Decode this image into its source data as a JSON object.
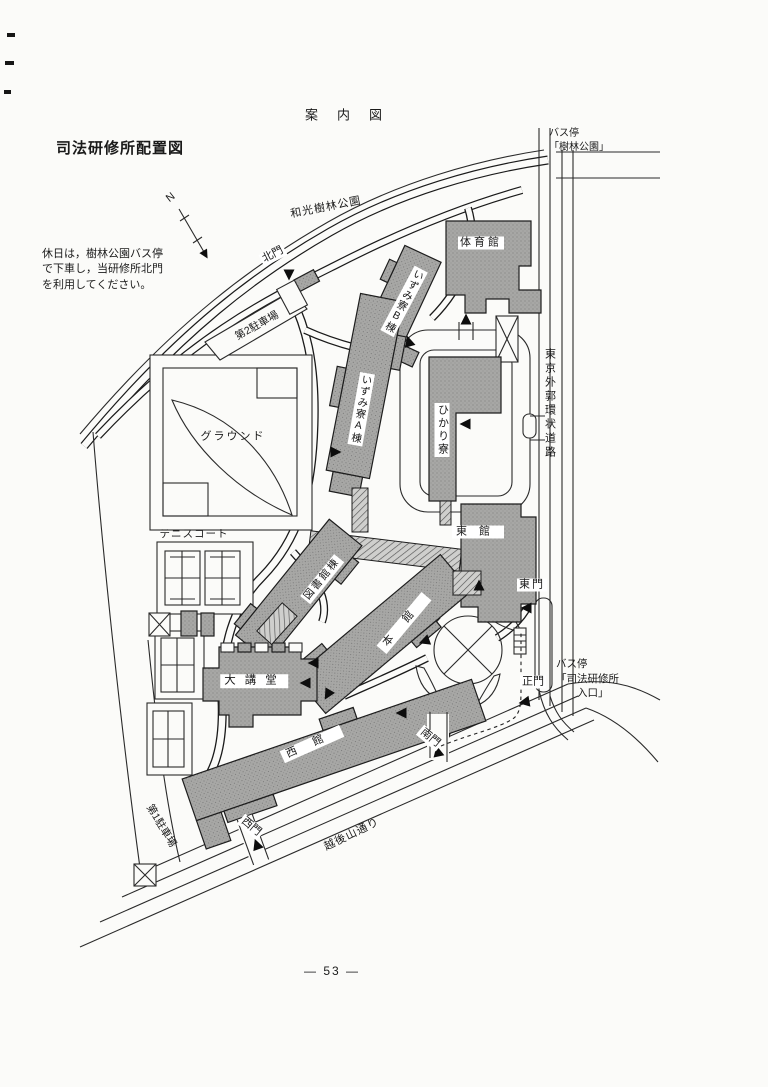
{
  "page": {
    "title": "案　内　図",
    "heading": "司法研修所配置図",
    "note": "休日は，樹林公園バス停\nで下車し，当研修所北門\nを利用してください。",
    "page_number": "— 53 —"
  },
  "map": {
    "compass_label": "N",
    "bus_stop_north": "バス停\n「樹林公園」",
    "bus_stop_east": "バス停\n「司法研修所\n　　入口」",
    "roads": {
      "wako_park": "和光樹林公園",
      "gaikan": "東京外郭環状道路",
      "echigoyama": "越後山通り"
    },
    "gates": {
      "north": "北門",
      "east": "東門",
      "main": "正門",
      "south": "南門",
      "west": "西門"
    },
    "buildings": {
      "gym": "体育館",
      "izumi_b": "いずみ寮B棟",
      "izumi_a": "いずみ寮A棟",
      "hikari": "ひかり寮",
      "east_bldg": "東館",
      "library": "図書館棟",
      "main_bldg": "本館",
      "auditorium": "大講堂",
      "west_bldg": "西館"
    },
    "areas": {
      "ground": "グラウンド",
      "tennis": "テニスコート",
      "parking1": "第1駐車場",
      "parking2": "第2駐車場"
    }
  }
}
